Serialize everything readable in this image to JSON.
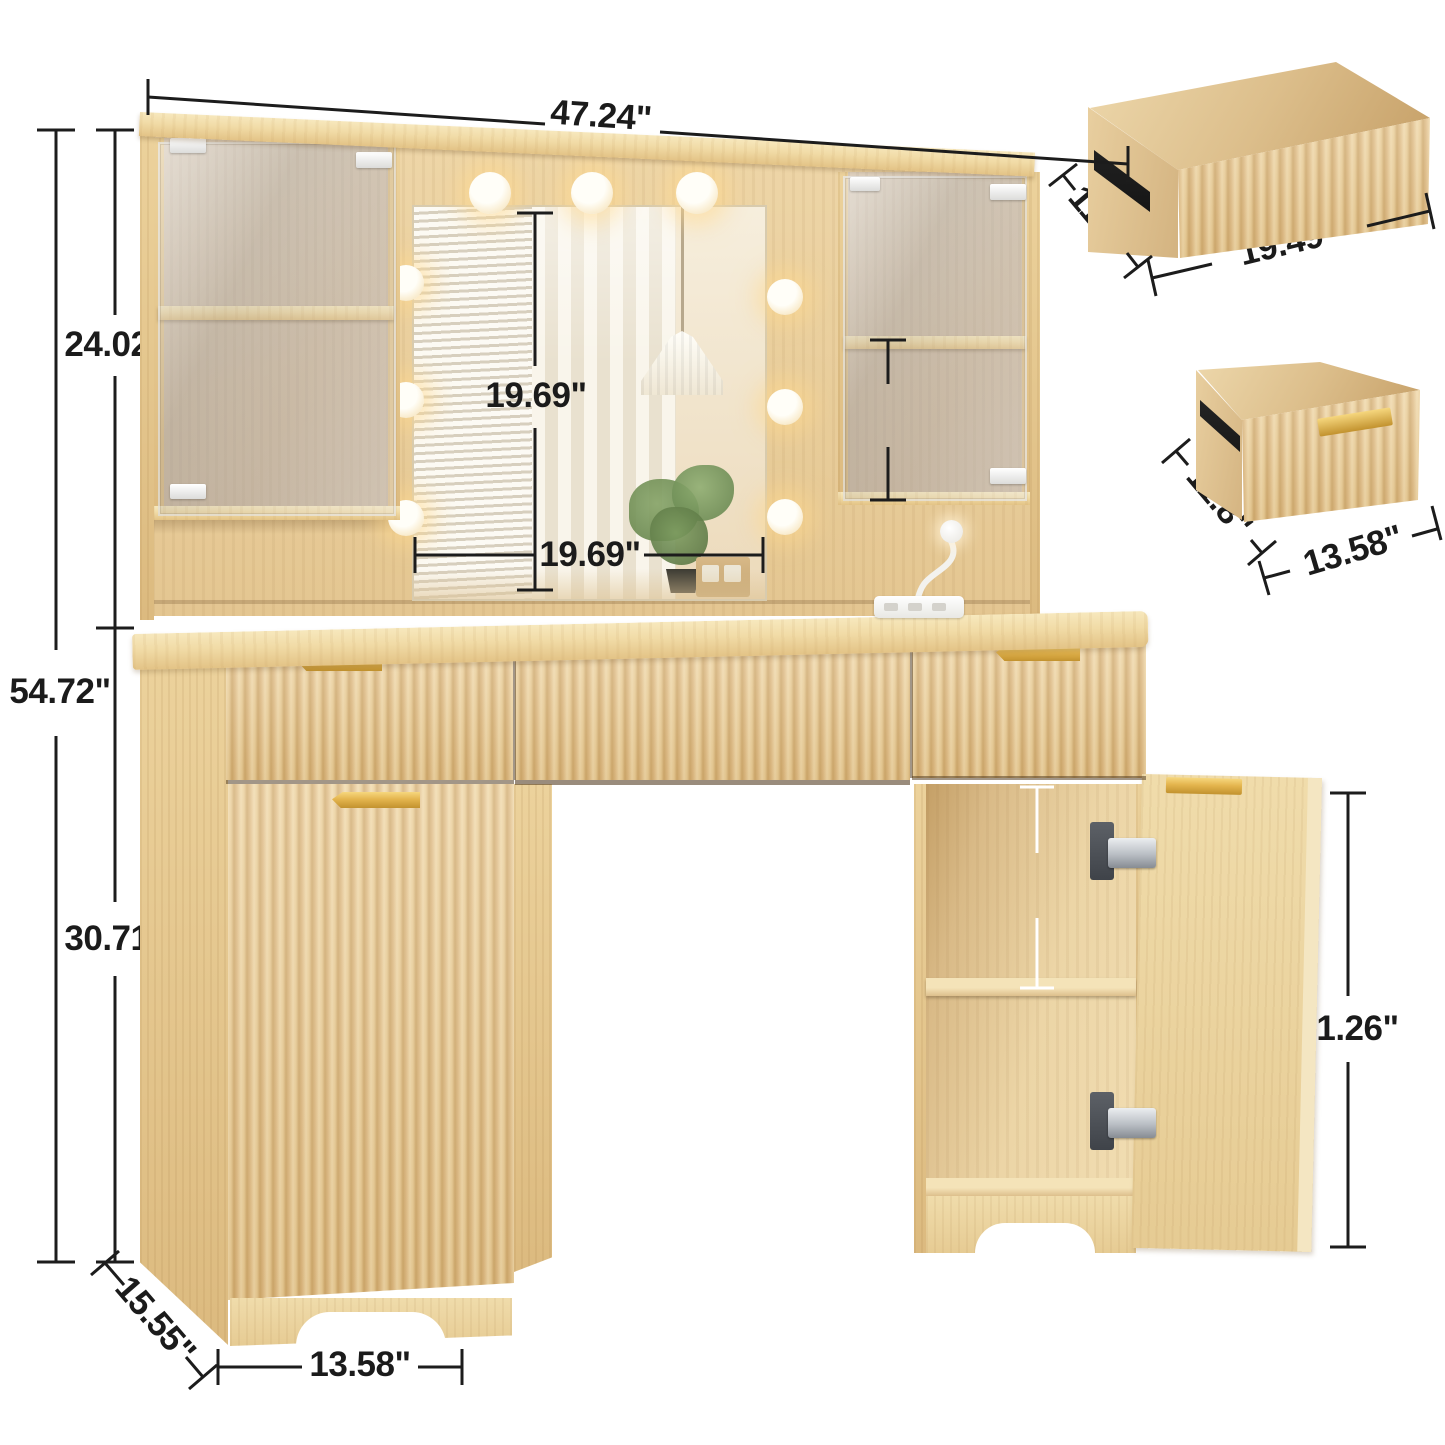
{
  "dims": {
    "top_width": "47.24\"",
    "hutch_height": "24.02\"",
    "total_height": "54.72\"",
    "base_height": "30.71\"",
    "mirror_height": "19.69\"",
    "mirror_width": "19.69\"",
    "upper_shelf_gap": "8.27\"",
    "lower_shelf_gap": "10\"",
    "door_height": "21.26\"",
    "depth": "15.55\"",
    "base_cabinet_width": "13.58\"",
    "drawer_large_depth": "11.8\"",
    "drawer_large_width": "19.49\"",
    "drawer_small_depth": "11.8\"",
    "drawer_small_width": "13.58\""
  },
  "colors": {
    "dimension_line": "#1c1c1c",
    "dimension_line_light": "#ffffff",
    "wood_main": "#ecd2a2",
    "wood_dark": "#cfa96c",
    "handle_gold": "#e4b54e",
    "background": "#ffffff"
  }
}
